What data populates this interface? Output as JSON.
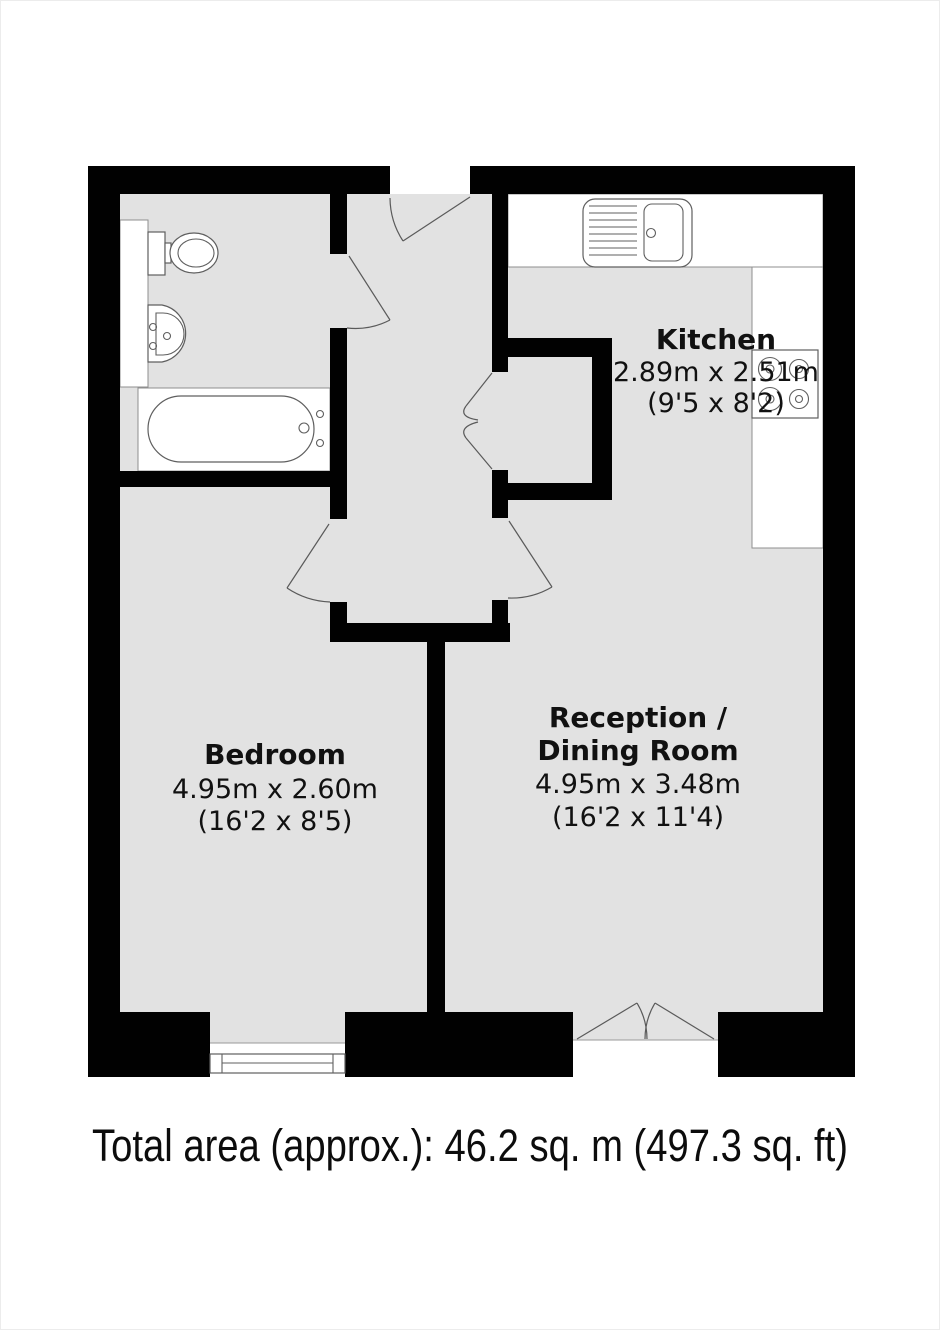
{
  "floorplan": {
    "rooms": {
      "kitchen": {
        "name": "Kitchen",
        "metric": "2.89m x 2.51m",
        "imperial": "(9'5 x 8'2)"
      },
      "bedroom": {
        "name": "Bedroom",
        "metric": "4.95m x 2.60m",
        "imperial": "(16'2 x 8'5)"
      },
      "reception": {
        "name_line1": "Reception /",
        "name_line2": "Dining Room",
        "metric": "4.95m x 3.48m",
        "imperial": "(16'2 x 11'4)"
      }
    },
    "footer": {
      "total_area": "Total area (approx.): 46.2 sq. m (497.3 sq. ft)"
    },
    "fixtures": {
      "bathroom": [
        "toilet-icon",
        "basin-icon",
        "bathtub-icon",
        "vanity-counter"
      ],
      "kitchen": [
        "kitchen-sink-icon",
        "hob-icon",
        "worktop-counter"
      ],
      "openings": [
        "entry-door-swing",
        "bathroom-door-swing",
        "cupboard-bifold-door",
        "bedroom-door-swing",
        "reception-door-swing",
        "french-doors-swing",
        "bedroom-window"
      ]
    },
    "colors": {
      "wall": "#010101",
      "floor": "#e2e2e2",
      "fixture_outline": "#5f5f5f",
      "background": "#ffffff"
    }
  }
}
